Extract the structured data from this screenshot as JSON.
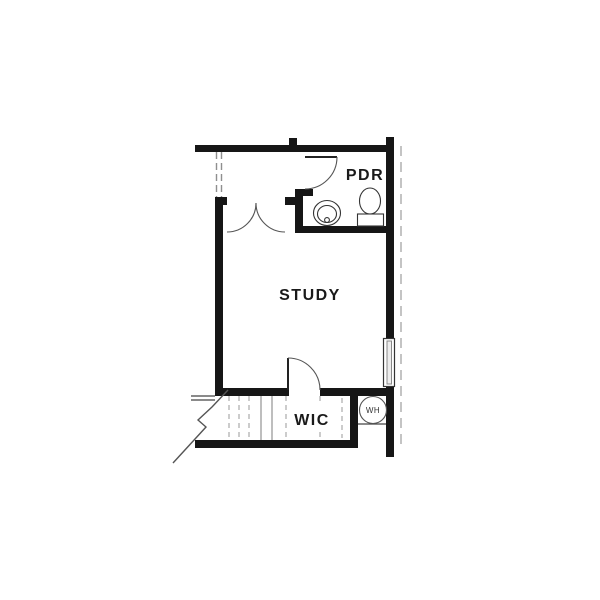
{
  "plan": {
    "type": "residential-floor-plan",
    "labels": {
      "study": "STUDY",
      "pdr": "PDR",
      "wic": "WIC",
      "wh": "WH"
    },
    "colors": {
      "background": "#ffffff",
      "wall": "#161616",
      "thin_line": "#444444",
      "stair_dash": "#9a9a9a",
      "overhead_dash": "#b5b5b5",
      "text": "#1a1a1a"
    }
  }
}
